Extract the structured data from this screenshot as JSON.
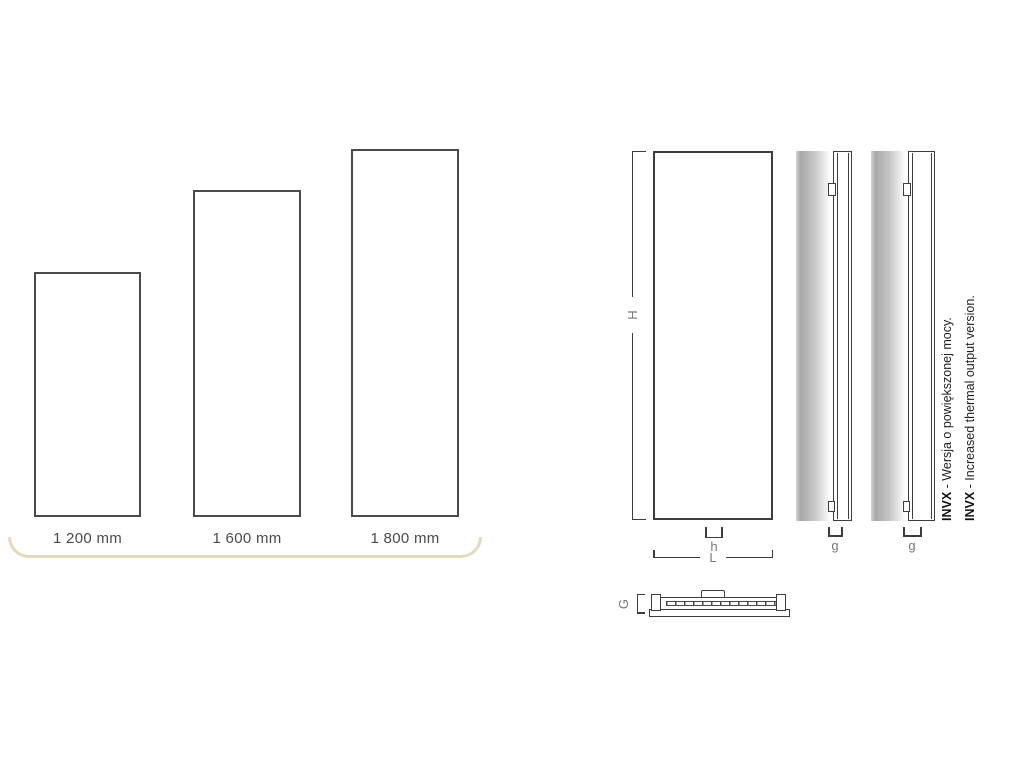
{
  "page": {
    "background_color": "#ffffff",
    "description_colors": {
      "drawing_line": "#3d3d3d",
      "comparison_rect_line": "#4a4a4a",
      "dimension_label": "#787878",
      "arc_accent": "#e4dabc",
      "note_text": "#1f1f1f"
    }
  },
  "size_comparison": {
    "items": [
      {
        "label": "1 200 mm",
        "height_mm": 1200
      },
      {
        "label": "1 600 mm",
        "height_mm": 1600
      },
      {
        "label": "1 800 mm",
        "height_mm": 1800
      }
    ]
  },
  "dimension_diagram": {
    "labels": {
      "H": "H",
      "h": "h",
      "L": "L",
      "g_standard": "g",
      "g_invx": "g",
      "G": "G"
    },
    "notes": [
      {
        "prefix": "INVX",
        "text": " - Wersja o powiększonej mocy."
      },
      {
        "prefix": "INVX",
        "text": " - Increased thermal output version."
      }
    ]
  }
}
